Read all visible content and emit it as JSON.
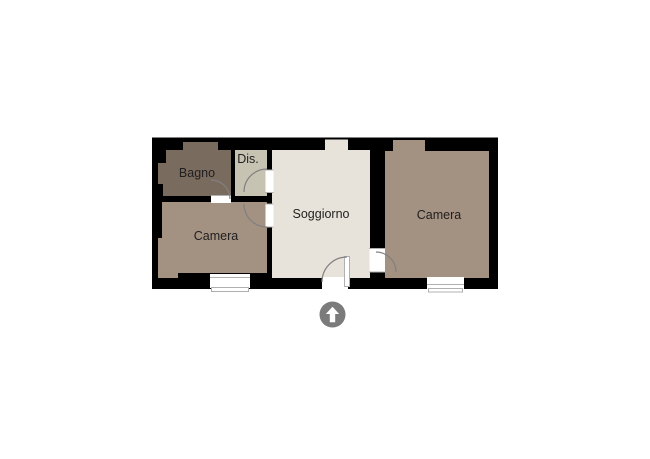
{
  "floorplan": {
    "rooms": {
      "bagno": {
        "label": "Bagno",
        "color": "#7a6b5f"
      },
      "dis": {
        "label": "Dis.",
        "color": "#c7c3b2"
      },
      "soggiorno": {
        "label": "Soggiorno",
        "color": "#e7e3da"
      },
      "camera_left": {
        "label": "Camera",
        "color": "#a39181"
      },
      "camera_right": {
        "label": "Camera",
        "color": "#a39181"
      }
    },
    "colors": {
      "wall": "#000000",
      "opening": "#ffffff",
      "door_arc": "#808080",
      "trim": "#b0b0b0",
      "label": "#1f1f1f",
      "background": "#ffffff",
      "compass_circle": "#7b7b7b",
      "compass_arrow": "#ffffff"
    },
    "compass": {
      "icon": "up-arrow-icon"
    }
  }
}
